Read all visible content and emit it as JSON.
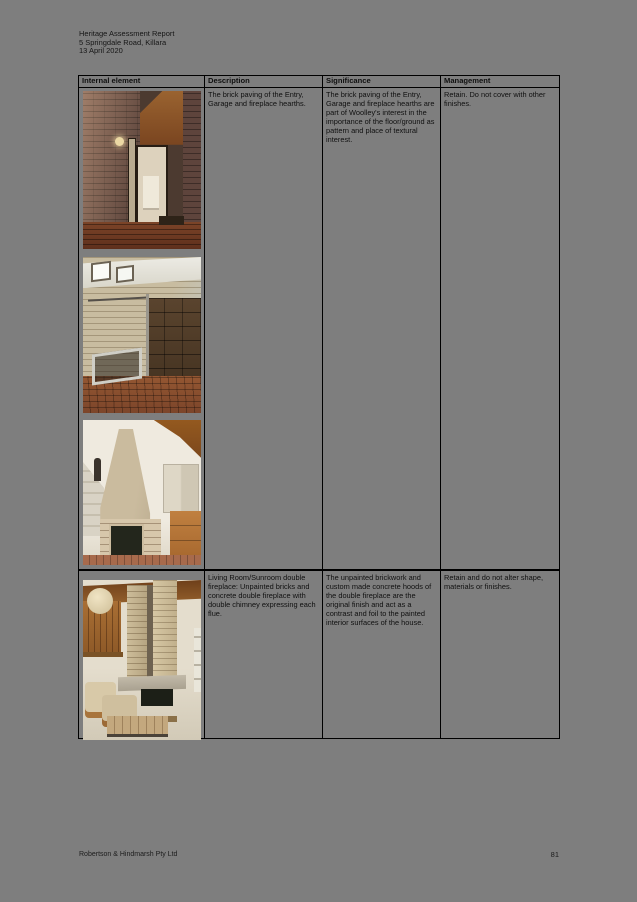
{
  "page": {
    "header_lines": {
      "0": "Heritage Assessment Report",
      "1": "5 Springdale Road, Killara",
      "2": "13 April 2020"
    },
    "footer_left": "Robertson & Hindmarsh Pty Ltd",
    "footer_page_number": "81",
    "background_color": "#7e7e7e",
    "border_color": "#000000"
  },
  "table": {
    "columns": {
      "0": "Internal element",
      "1": "Description",
      "2": "Significance",
      "3": "Management"
    },
    "rows": {
      "0": {
        "description": "The brick paving of the Entry, Garage and fireplace hearths.",
        "significance": "The brick paving of the Entry, Garage and fireplace hearths are part of Woolley's interest in the importance of the floor/ground as pattern and place of textural interest.",
        "management": "Retain. Do not cover with other finishes.",
        "photos": {
          "0": {
            "alt": "Entry hall with face brick walls, timber ceiling, glazed door and brick paving"
          },
          "1": {
            "alt": "Garage interior with brick walls, clerestory windows, timber panel door and brick paved floor"
          },
          "2": {
            "alt": "Fireplace with sloped concrete hood, brick base and brick hearth beside timber joinery"
          }
        }
      },
      "1": {
        "description": "Living Room/Sunroom double fireplace: Unpainted bricks and concrete double fireplace with double chimney expressing each flue.",
        "significance": "The unpainted brickwork and custom made concrete hoods of the double fireplace are the original finish and act as a contrast and foil to the painted interior surfaces of the house.",
        "management": "Retain and do not alter shape, materials or finishes.",
        "photos": {
          "0": {
            "alt": "Double-height living room with unpainted brick double chimney, concrete hood, timber ceiling and armchairs"
          }
        }
      }
    }
  }
}
